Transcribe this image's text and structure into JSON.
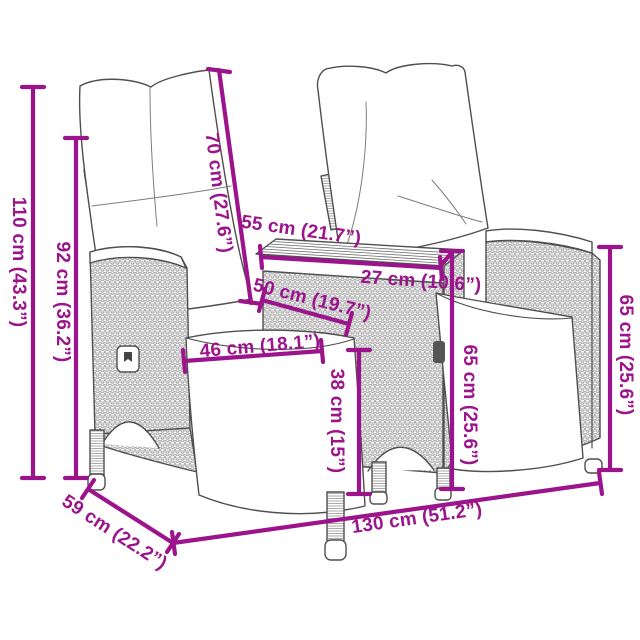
{
  "diagram_type": "furniture-dimension-diagram",
  "colors": {
    "dimension_accent": "#9C148C",
    "line_art": "#4f4f4f",
    "background": "#ffffff"
  },
  "dimensions": {
    "total_height": {
      "label": "110 cm (43.3”)",
      "cm": 110,
      "inch": 43.3
    },
    "back_height": {
      "label": "92 cm (36.2”)",
      "cm": 92,
      "inch": 36.2
    },
    "backrest_length": {
      "label": "70 cm (27.6”)",
      "cm": 70,
      "inch": 27.6
    },
    "table_top_length": {
      "label": "55 cm (21.7”)",
      "cm": 55,
      "inch": 21.7
    },
    "table_depth": {
      "label": "27 cm (10.6”)",
      "cm": 27,
      "inch": 10.6
    },
    "table_base_length": {
      "label": "50 cm (19.7”)",
      "cm": 50,
      "inch": 19.7
    },
    "seat_width": {
      "label": "46 cm (18.1”)",
      "cm": 46,
      "inch": 18.1
    },
    "seat_height": {
      "label": "38 cm (15”)",
      "cm": 38,
      "inch": 15
    },
    "table_height": {
      "label": "65 cm (25.6”)",
      "cm": 65,
      "inch": 25.6
    },
    "armrest_height": {
      "label": "65 cm (25.6”)",
      "cm": 65,
      "inch": 25.6
    },
    "total_width": {
      "label": "130 cm (51.2”)",
      "cm": 130,
      "inch": 51.2
    },
    "total_depth": {
      "label": "59 cm (22.2”)",
      "cm": 59,
      "inch": 22.2
    }
  }
}
